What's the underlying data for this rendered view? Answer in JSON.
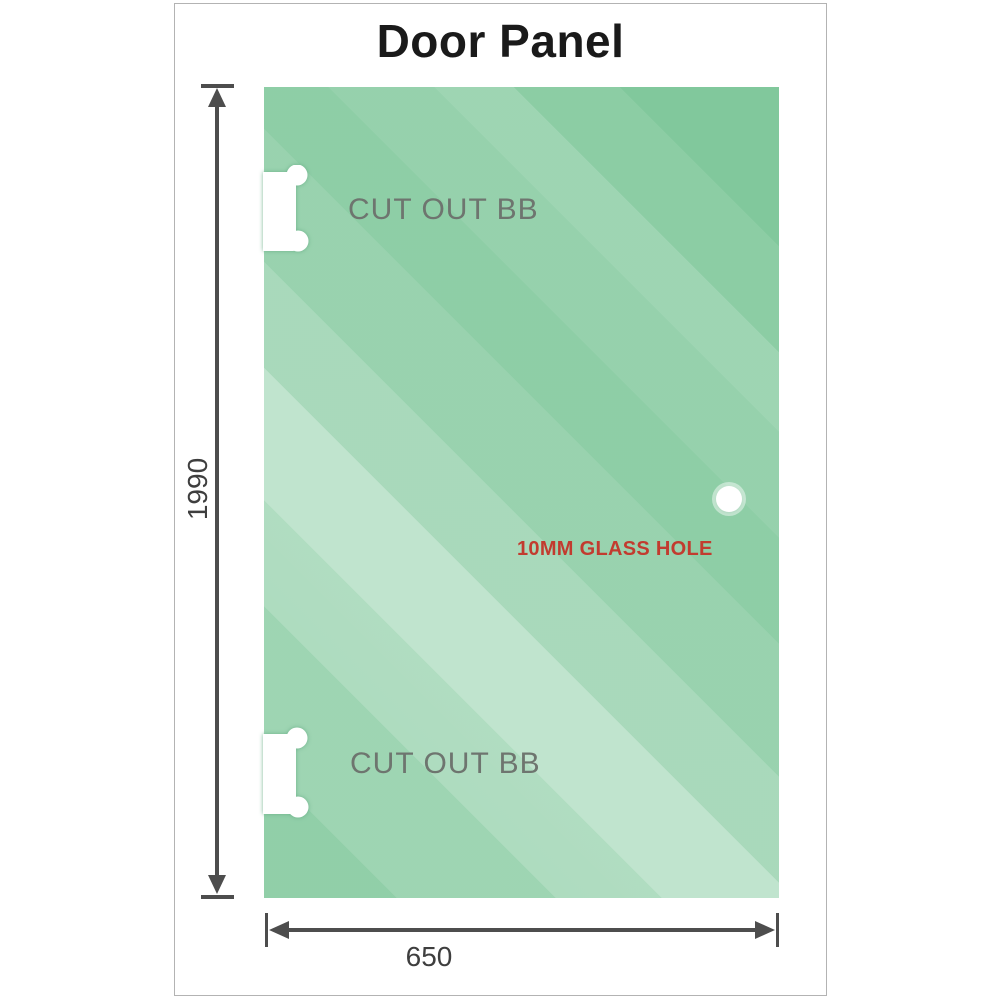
{
  "title": "Door Panel",
  "panel": {
    "height_label": "1990",
    "width_label": "650",
    "annotations": {
      "cutout_top": "CUT OUT BB",
      "cutout_bottom": "CUT OUT BB",
      "glass_hole": "10MM GLASS HOLE"
    }
  },
  "colors": {
    "glass_green": "#7cc698",
    "glass_highlight": "#cdead8",
    "dimension_line": "#4d4d4d",
    "cutout_text": "#6e756f",
    "hole_text": "#c23b2f",
    "title_text": "#1a1a1a",
    "frame_border": "#b3b3b3"
  }
}
